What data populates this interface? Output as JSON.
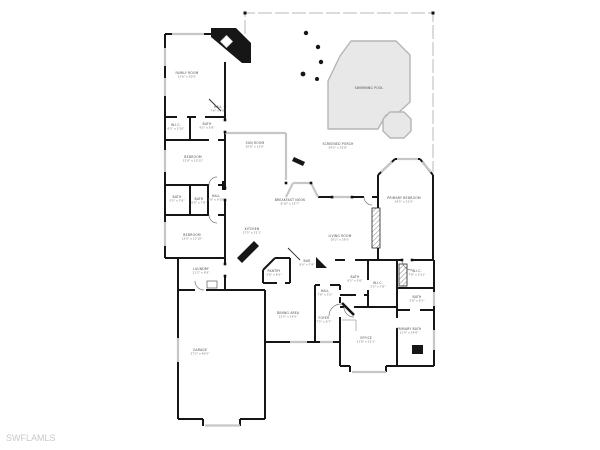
{
  "watermark": "SWFLAMLS",
  "plan": {
    "colors": {
      "background": "#ffffff",
      "wall": "#161616",
      "pool_fill": "#e8e8e8",
      "pool_stroke": "#b5b5b5",
      "screen_line": "#b9b9b9",
      "label": "#4a4a4a",
      "watermark": "#c9c9c9"
    },
    "rooms": [
      {
        "id": "family-room",
        "name": "FAMILY ROOM",
        "dims": "13'8\" x 20'6\"",
        "x": 187,
        "y": 74
      },
      {
        "id": "hall-1",
        "name": "HALL",
        "dims": "7'6\" x 7'0\"",
        "x": 218,
        "y": 108
      },
      {
        "id": "wic-1",
        "name": "W.I.C.",
        "dims": "6'5\" x 5'10\"",
        "x": 176,
        "y": 126
      },
      {
        "id": "bath-1",
        "name": "BATH",
        "dims": "9'5\" x 5'8\"",
        "x": 207,
        "y": 125
      },
      {
        "id": "bedroom-1",
        "name": "BEDROOM",
        "dims": "12'8\" x 13'11\"",
        "x": 193,
        "y": 158
      },
      {
        "id": "bath-2",
        "name": "BATH",
        "dims": "5'5\" x 7'8\"",
        "x": 177,
        "y": 198
      },
      {
        "id": "bath-3",
        "name": "BATH",
        "dims": "6'0\" x 7'8\"",
        "x": 199,
        "y": 200
      },
      {
        "id": "hall-2",
        "name": "HALL",
        "dims": "3'8\" x 9'10\"",
        "x": 216,
        "y": 197
      },
      {
        "id": "bedroom-2",
        "name": "BEDROOM",
        "dims": "13'5\" x 12'10\"",
        "x": 192,
        "y": 236
      },
      {
        "id": "sun-room",
        "name": "SUN ROOM",
        "dims": "20'8\" x 13'0\"",
        "x": 255,
        "y": 144
      },
      {
        "id": "screened-porch",
        "name": "SCREENED PORCH",
        "dims": "54'5\" x 52'8\"",
        "x": 338,
        "y": 145
      },
      {
        "id": "swimming-pool",
        "name": "SWIMMING POOL",
        "dims": "",
        "x": 369,
        "y": 89
      },
      {
        "id": "breakfast-nook",
        "name": "BREAKFAST NOOK",
        "dims": "8'10\" x 15'7\"",
        "x": 290,
        "y": 201
      },
      {
        "id": "kitchen",
        "name": "KITCHEN",
        "dims": "17'5\" x 21'1\"",
        "x": 252,
        "y": 230
      },
      {
        "id": "living-room",
        "name": "LIVING ROOM",
        "dims": "20'2\" x 19'5\"",
        "x": 340,
        "y": 237
      },
      {
        "id": "primary-bedroom",
        "name": "PRIMARY BEDROOM",
        "dims": "14'5\" x 21'0\"",
        "x": 404,
        "y": 199
      },
      {
        "id": "laundry",
        "name": "LAUNDRY",
        "dims": "11'2\" x 6'9\"",
        "x": 201,
        "y": 270
      },
      {
        "id": "bar",
        "name": "BAR",
        "dims": "8'0\" x 7'4\"",
        "x": 307,
        "y": 262
      },
      {
        "id": "pantry",
        "name": "PANTRY",
        "dims": "5'8\" x 6'5\"",
        "x": 274,
        "y": 272
      },
      {
        "id": "dining-area",
        "name": "DINING AREA",
        "dims": "12'5\" x 14'6\"",
        "x": 288,
        "y": 314
      },
      {
        "id": "hall-3",
        "name": "HALL",
        "dims": "7'8\" x 5'5\"",
        "x": 325,
        "y": 292
      },
      {
        "id": "foyer",
        "name": "FOYER",
        "dims": "7'5\" x 6'7\"",
        "x": 324,
        "y": 319
      },
      {
        "id": "office",
        "name": "OFFICE",
        "dims": "11'8\" x 13'1\"",
        "x": 366,
        "y": 339
      },
      {
        "id": "primary-bath",
        "name": "PRIMARY BATH",
        "dims": "11'4\" x 14'8\"",
        "x": 409,
        "y": 330
      },
      {
        "id": "bath-4",
        "name": "BATH",
        "dims": "8'5\" x 5'6\"",
        "x": 355,
        "y": 278
      },
      {
        "id": "wic-2",
        "name": "W.I.C.",
        "dims": "5'5\" x 7'8\"",
        "x": 378,
        "y": 284
      },
      {
        "id": "wic-3",
        "name": "W.I.C.",
        "dims": "7'8\" x 5'11\"",
        "x": 417,
        "y": 272
      },
      {
        "id": "bath-5",
        "name": "BATH",
        "dims": "5'8\" x 8'3\"",
        "x": 417,
        "y": 298
      },
      {
        "id": "garage",
        "name": "GARAGE",
        "dims": "27'2\" x 40'5\"",
        "x": 200,
        "y": 351
      }
    ]
  }
}
